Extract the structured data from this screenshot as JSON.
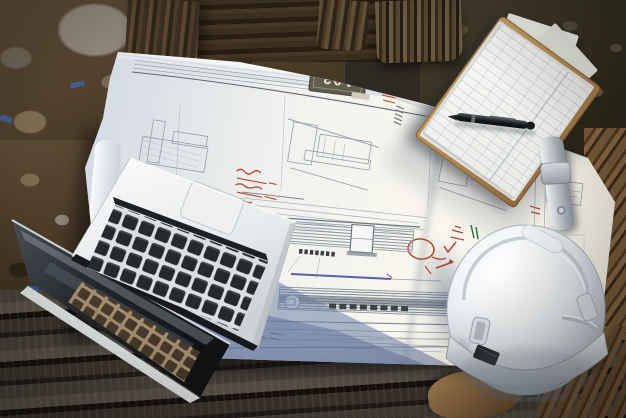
{
  "scene": {
    "type": "photograph",
    "setting": "construction site work table",
    "objects": [
      "architectural blueprint sheet",
      "open laptop",
      "white safety helmet",
      "clipboard with forms",
      "black pen",
      "wooden planks",
      "rocky soil"
    ]
  },
  "blueprint": {
    "sheet_label": "A03"
  },
  "colors": {
    "paper": "#f1f2ef",
    "paper_shadow_blue": "#a9bbd4",
    "drawing_line": "#8d99a6",
    "annotation_red": "#bf4329",
    "annotation_green": "#3e7d49",
    "annotation_blue": "#5a5fae",
    "helmet_white": "#e9edf0",
    "laptop_body": "#f0f2f3",
    "laptop_keys": "#26292c",
    "clipboard_board": "#c49a66",
    "pen_black": "#17191b",
    "wood_dark": "#332f2a",
    "soil_brown": "#5c4730"
  }
}
